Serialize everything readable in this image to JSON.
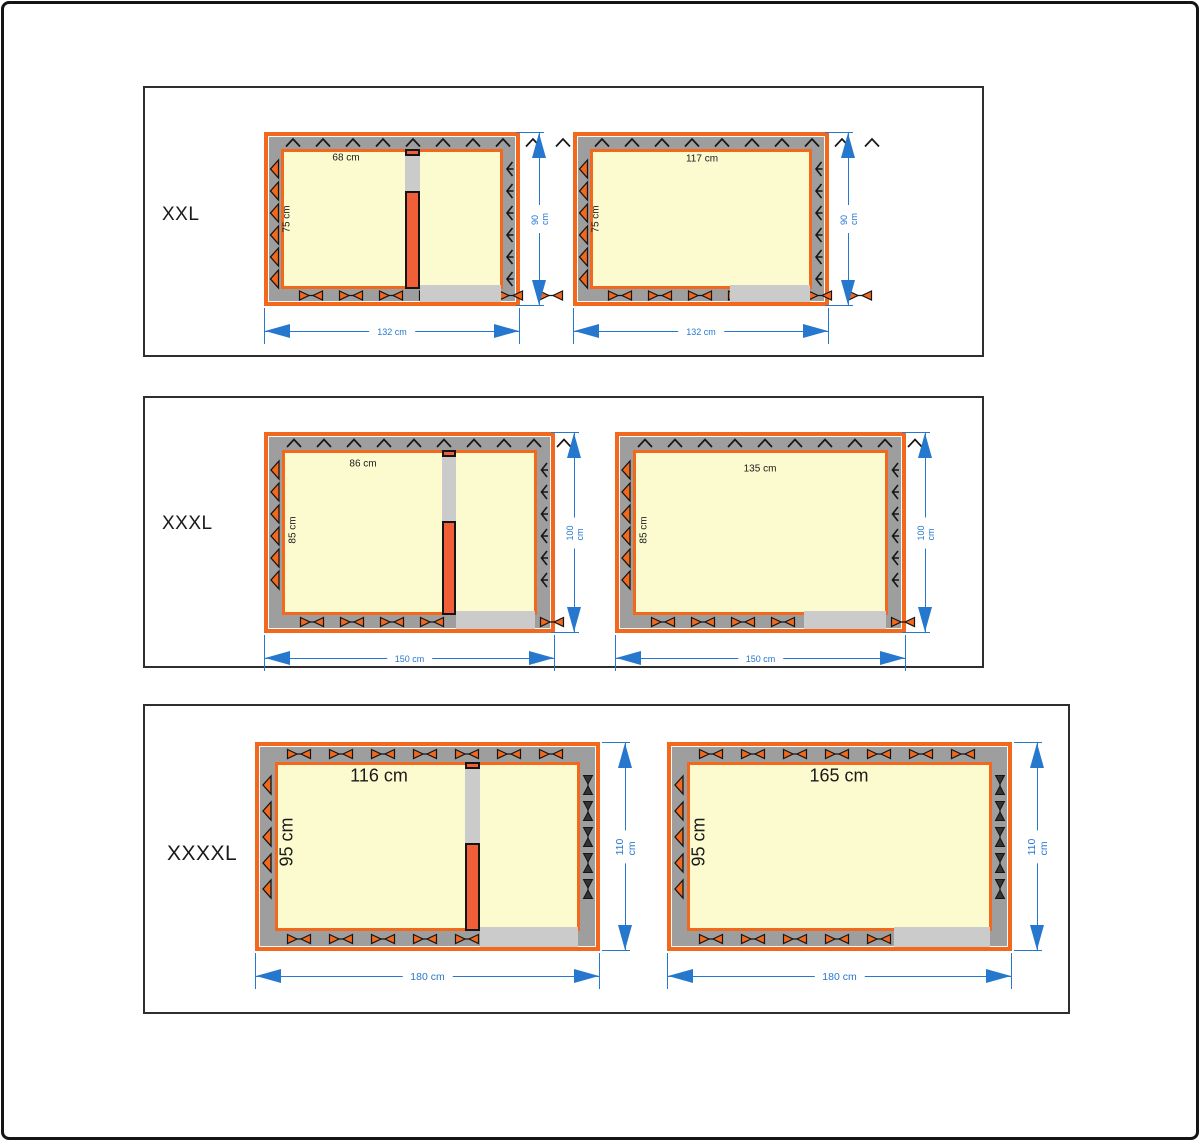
{
  "colors": {
    "outline_orange": "#F2691D",
    "divider_orange": "#F05F37",
    "wall_gray": "#9E9E9E",
    "opening_gray": "#CBCBCB",
    "floor_yellow": "#FCFACF",
    "dimension_blue": "#2678CE",
    "label_black": "#1A1A1A"
  },
  "panels": [
    {
      "size_label": "XXL",
      "diagrams": [
        {
          "inner_width": "68 cm",
          "inner_height": "75 cm",
          "outer_width": "132 cm",
          "outer_height": "90 cm"
        },
        {
          "inner_width": "117 cm",
          "inner_height": "75 cm",
          "outer_width": "132 cm",
          "outer_height": "90 cm"
        }
      ]
    },
    {
      "size_label": "XXXL",
      "diagrams": [
        {
          "inner_width": "86 cm",
          "inner_height": "85 cm",
          "outer_width": "150 cm",
          "outer_height": "100 cm"
        },
        {
          "inner_width": "135 cm",
          "inner_height": "85 cm",
          "outer_width": "150 cm",
          "outer_height": "100 cm"
        }
      ]
    },
    {
      "size_label": "XXXXL",
      "diagrams": [
        {
          "inner_width": "116 cm",
          "inner_height": "95 cm",
          "outer_width": "180 cm",
          "outer_height": "110 cm"
        },
        {
          "inner_width": "165 cm",
          "inner_height": "95 cm",
          "outer_width": "180 cm",
          "outer_height": "110 cm"
        }
      ]
    }
  ]
}
